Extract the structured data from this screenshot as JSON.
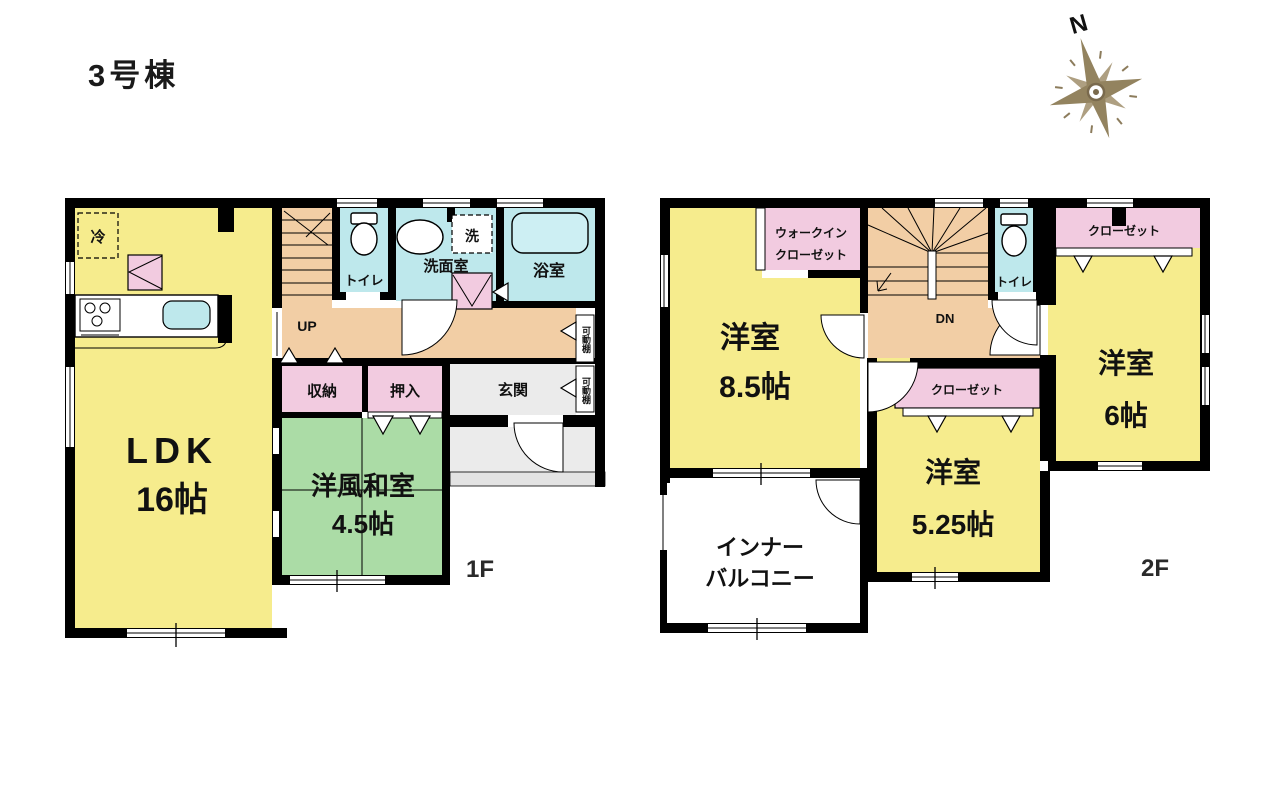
{
  "title": "3号棟",
  "compass": {
    "north_label": "N"
  },
  "floor1": {
    "floor_label": "1F",
    "ldk_name": "LDK",
    "ldk_size": "16帖",
    "washitsu_name": "洋風和室",
    "washitsu_size": "4.5帖",
    "storage_label": "収納",
    "oshiire_label": "押入",
    "genkan_label": "玄関",
    "toilet_label": "トイレ",
    "washroom_label": "洗面室",
    "bath_label": "浴室",
    "fridge_label": "冷",
    "washer_label": "洗",
    "stairs_label": "UP",
    "shelf_label_a": "可動棚",
    "shelf_label_b": "可動棚"
  },
  "floor2": {
    "floor_label": "2F",
    "bedroom1_name": "洋室",
    "bedroom1_size": "8.5帖",
    "bedroom2_name": "洋室",
    "bedroom2_size": "5.25帖",
    "bedroom3_name": "洋室",
    "bedroom3_size": "6帖",
    "wic_line1": "ウォークイン",
    "wic_line2": "クローゼット",
    "closet_top_label": "クローゼット",
    "closet_mid_label": "クローゼット",
    "toilet_label": "トイレ",
    "stairs_label": "DN",
    "balcony_line1": "インナー",
    "balcony_line2": "バルコニー"
  },
  "colors": {
    "wall": "#000000",
    "room_yellow": "#F6EC8D",
    "room_green": "#ABDCA6",
    "room_pink": "#F2CBE0",
    "room_blue": "#BEE8EC",
    "hall_orange": "#F2CEA5",
    "entry_gray": "#EBEBEB",
    "porch_gray": "#E3E3E3",
    "compass_tan": "#8F7F5F"
  }
}
